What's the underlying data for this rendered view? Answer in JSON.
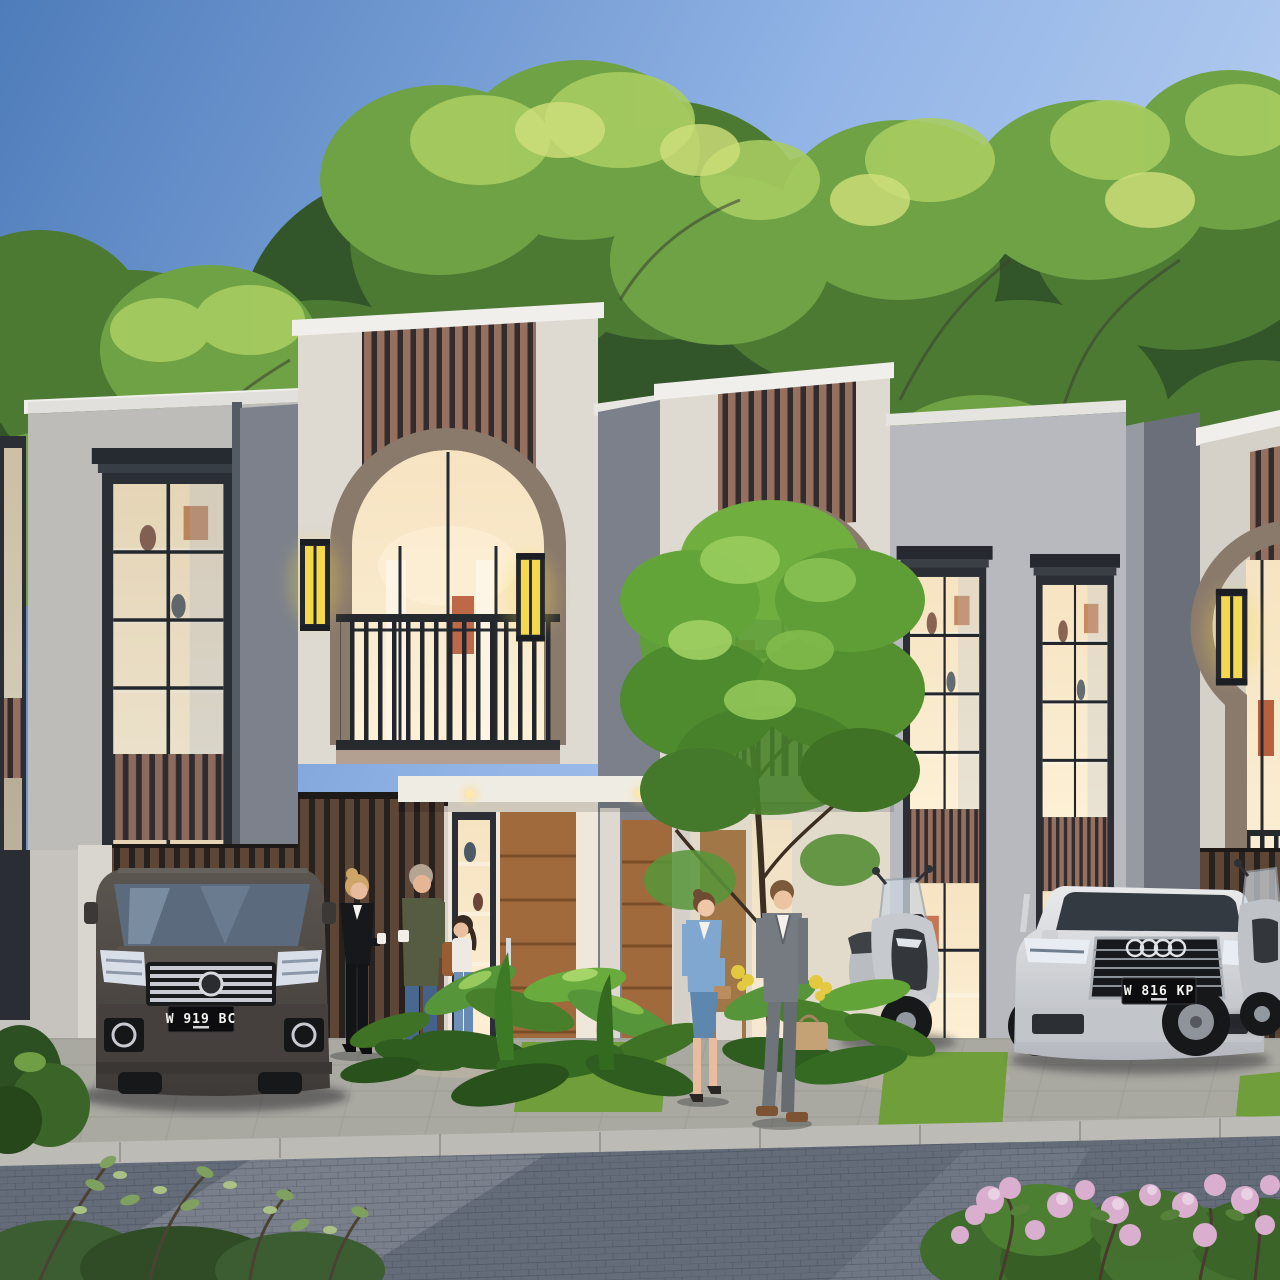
{
  "scene": {
    "description": "Dusk 3D architectural rendering of a row of modern two-storey townhouses with cream stucco, vertical wood-slat accent panels, arched second-floor balcony windows, warm lit interiors and yellow wall sconces; residents stand and walk on the paver street where a dark MPV, a white SUV and two scooters are parked; lush green trees rise behind the roofline under a blue sky.",
    "setting": "residential townhouse street",
    "time_of_day": "dusk"
  },
  "license_plates": {
    "mpv": "W 919 BC",
    "suv": "W 816 KP"
  },
  "vehicles": [
    {
      "name": "mpv",
      "description": "dark grey luxury MPV with chrome multi-bar grille, parked facing the street",
      "plate": "W 919 BC"
    },
    {
      "name": "suv",
      "description": "white luxury SUV with four-ring grille badge, parked facing the street",
      "plate": "W 816 KP"
    },
    {
      "name": "scooter-1",
      "description": "silver maxi scooter parked beside the SUV"
    },
    {
      "name": "scooter-2",
      "description": "second scooter partially visible at the right edge"
    }
  ],
  "people": [
    {
      "name": "woman-black-suit",
      "description": "blonde woman in a black pantsuit holding a cup, chatting by the first house"
    },
    {
      "name": "man-olive-sweater",
      "description": "grey-haired man in an olive sweater and blue jeans holding a white mug"
    },
    {
      "name": "girl-backpack",
      "description": "girl in a white top and jeans with a brown backpack and blue sneakers"
    },
    {
      "name": "woman-blue-suit",
      "description": "woman in a light blue skirt suit with a small tan handbag walking on the sidewalk"
    },
    {
      "name": "man-grey-suit",
      "description": "man in a grey suit carrying a tan leather bag walking beside her"
    }
  ],
  "buildings": {
    "units": 4,
    "style": "modern tropical townhouse: cream stucco, dark window frames, vertical wood-slat accent panels, arched balcony windows, yellow wall sconces, warm lit interiors, tall shelf-lined windows",
    "landscaping": "tropical shrub beds, lawn strips, young street tree, pink flowering bush, leafy shrubs in the foreground"
  },
  "colors": {
    "sky_top": "#4e7cba",
    "sky_mid": "#92b4e6",
    "sky_light": "#d3e2f8",
    "wall_cream": "#ded9d1",
    "wall_cream_shaded": "#cbc8c4",
    "wall_grey": "#7e838d",
    "coping_white": "#f1efeb",
    "arch_trim": "#8a7a6c",
    "frame_dark": "#2b2f35",
    "slat_wood": "#96705f",
    "slat_gap": "#322c2e",
    "fence_wood": "#5e4637",
    "window_glow_top": "#f6e3c1",
    "window_glow_bottom": "#fcf0d6",
    "sconce_yellow": "#f4d94e",
    "door_wood": "#a06a3c",
    "grass": "#6f9e3a",
    "plant_green": "#559431",
    "pavement": "#a9a8a1",
    "curb": "#bcbbb5",
    "road": "#646c7a",
    "road_light": "#8d939d",
    "mpv_body": "#4e4843",
    "suv_body": "#d7d8da",
    "plate_bg": "#0c0c0e",
    "plate_text": "#f4f4f1",
    "flower_pink": "#d9aecf",
    "foliage_mid": "#4c7a33"
  }
}
